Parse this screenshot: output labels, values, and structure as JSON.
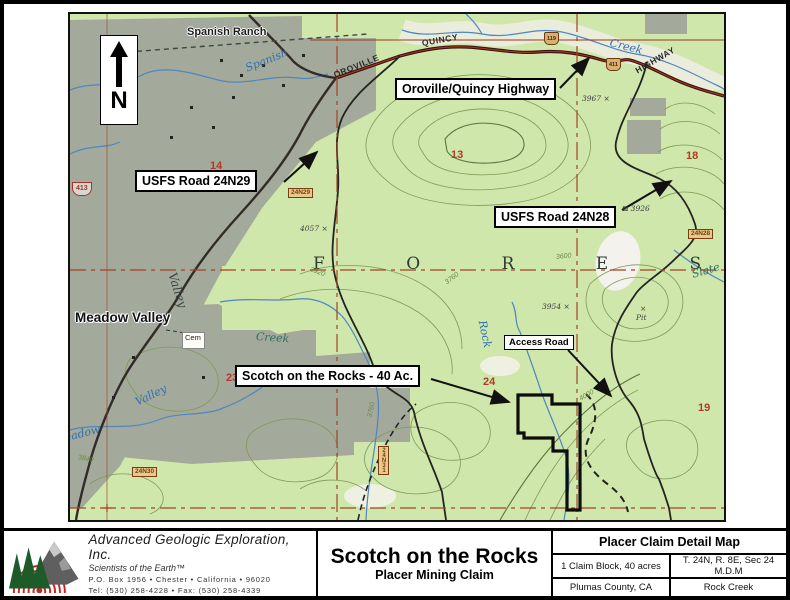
{
  "map": {
    "north_arrow": {
      "label": "N"
    },
    "claim": {
      "name": "Scotch on the Rocks",
      "size": "40 Ac.",
      "outline_color": "#0d0d0d"
    },
    "callouts": [
      {
        "text": "Oroville/Quincy Highway",
        "x": 325,
        "y": 64,
        "small": false
      },
      {
        "text": "USFS Road 24N29",
        "x": 65,
        "y": 156,
        "small": false
      },
      {
        "text": "USFS Road 24N28",
        "x": 424,
        "y": 192,
        "small": false
      },
      {
        "text": "Scotch on the Rocks - 40 Ac.",
        "x": 165,
        "y": 351,
        "small": false
      },
      {
        "text": "Access Road",
        "x": 434,
        "y": 321,
        "small": true
      }
    ],
    "labels": [
      {
        "text": "Spanish Ranch",
        "x": 117,
        "y": 12,
        "rot": 0,
        "cls": "place"
      },
      {
        "text": "Meadow Valley",
        "x": 5,
        "y": 296,
        "rot": 0,
        "cls": "place-lg"
      },
      {
        "text": "QUINCY",
        "x": 352,
        "y": 24,
        "rot": -10,
        "cls": "road"
      },
      {
        "text": "OROVILLE",
        "x": 264,
        "y": 56,
        "rot": -22,
        "cls": "road"
      },
      {
        "text": "HIGHWAY",
        "x": 566,
        "y": 52,
        "rot": -30,
        "cls": "road"
      },
      {
        "text": "F O R E S T",
        "x": 243,
        "y": 240,
        "rot": 0,
        "cls": "forest"
      },
      {
        "text": "Cem",
        "x": 112,
        "y": 318,
        "rot": 0,
        "cls": "cem"
      },
      {
        "text": "Spanish",
        "x": 176,
        "y": 48,
        "rot": -22,
        "cls": "water"
      },
      {
        "text": "Creek",
        "x": 540,
        "y": 22,
        "rot": 14,
        "cls": "water"
      },
      {
        "text": "Creek",
        "x": 186,
        "y": 316,
        "rot": 4,
        "cls": "water-dk"
      },
      {
        "text": "Rock",
        "x": 412,
        "y": 300,
        "rot": 78,
        "cls": "water"
      },
      {
        "text": "Valley",
        "x": 102,
        "y": 252,
        "rot": 72,
        "cls": "dark-it"
      },
      {
        "text": "Valley",
        "x": 66,
        "y": 382,
        "rot": -26,
        "cls": "water"
      },
      {
        "text": "Meadow",
        "x": -16,
        "y": 420,
        "rot": -14,
        "cls": "water"
      },
      {
        "text": "Slate",
        "x": 622,
        "y": 254,
        "rot": -16,
        "cls": "water-dk"
      },
      {
        "text": "14",
        "x": 140,
        "y": 146,
        "rot": 0,
        "cls": "sec"
      },
      {
        "text": "13",
        "x": 381,
        "y": 135,
        "rot": 0,
        "cls": "sec"
      },
      {
        "text": "18",
        "x": 616,
        "y": 136,
        "rot": 0,
        "cls": "sec"
      },
      {
        "text": "23",
        "x": 156,
        "y": 358,
        "rot": 0,
        "cls": "sec"
      },
      {
        "text": "24",
        "x": 413,
        "y": 362,
        "rot": 0,
        "cls": "sec"
      },
      {
        "text": "19",
        "x": 628,
        "y": 388,
        "rot": 0,
        "cls": "sec"
      },
      {
        "text": "3967 ×",
        "x": 512,
        "y": 80,
        "rot": 0,
        "cls": "elev"
      },
      {
        "text": "4057 ×",
        "x": 230,
        "y": 210,
        "rot": 0,
        "cls": "elev"
      },
      {
        "text": "⊠ 3926",
        "x": 552,
        "y": 190,
        "rot": 0,
        "cls": "elev"
      },
      {
        "text": "3954 ×",
        "x": 472,
        "y": 288,
        "rot": 0,
        "cls": "elev"
      },
      {
        "text": "×",
        "x": 570,
        "y": 290,
        "rot": 0,
        "cls": "elev"
      },
      {
        "text": "Pit",
        "x": 566,
        "y": 299,
        "rot": 0,
        "cls": "elev"
      },
      {
        "text": "3600",
        "x": 486,
        "y": 240,
        "rot": -6,
        "cls": "cont"
      },
      {
        "text": "3920",
        "x": 240,
        "y": 252,
        "rot": 20,
        "cls": "cont"
      },
      {
        "text": "3760",
        "x": 376,
        "y": 266,
        "rot": -38,
        "cls": "cont"
      },
      {
        "text": "3840",
        "x": 8,
        "y": 440,
        "rot": 12,
        "cls": "cont"
      },
      {
        "text": "3760",
        "x": 300,
        "y": 400,
        "rot": -78,
        "cls": "cont"
      },
      {
        "text": "4000",
        "x": 510,
        "y": 382,
        "rot": -30,
        "cls": "cont"
      }
    ],
    "shields": [
      {
        "text": "24N29",
        "x": 218,
        "y": 174,
        "type": "h"
      },
      {
        "text": "24N28",
        "x": 618,
        "y": 215,
        "type": "h"
      },
      {
        "text": "24N30",
        "x": 62,
        "y": 453,
        "type": "h"
      },
      {
        "text": "24N31",
        "x": 308,
        "y": 432,
        "type": "v"
      },
      {
        "text": "413",
        "x": 2,
        "y": 168,
        "type": "pent"
      },
      {
        "text": "119",
        "x": 474,
        "y": 18,
        "type": "trap"
      },
      {
        "text": "411",
        "x": 536,
        "y": 44,
        "type": "trap"
      }
    ]
  },
  "footer": {
    "company": {
      "name": "Advanced Geologic Exploration, Inc.",
      "tagline": "Scientists of the Earth™",
      "address": "P.O. Box 1956 • Chester • California • 96020",
      "phone": "Tel: (530) 258-4228 • Fax: (530) 258-4339"
    },
    "title": "Scotch on the Rocks",
    "subtitle": "Placer Mining Claim",
    "detail": {
      "header": "Placer Claim Detail Map",
      "rows": [
        [
          "1 Claim Block, 40 acres",
          "T. 24N, R. 8E, Sec 24 M.D.M"
        ],
        [
          "Plumas County, CA",
          "Rock Creek"
        ]
      ]
    }
  }
}
